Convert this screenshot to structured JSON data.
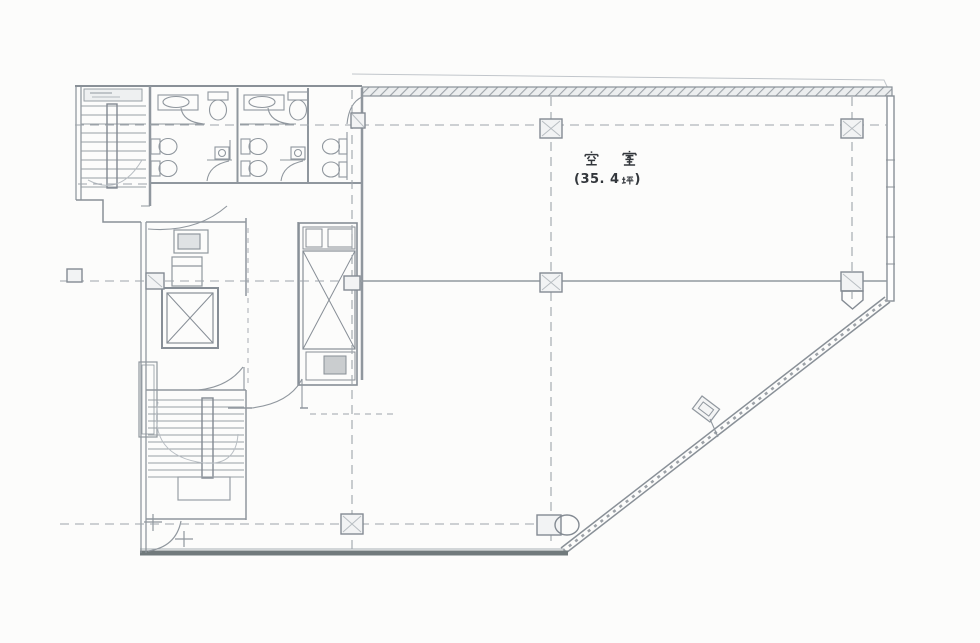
{
  "floor_plan": {
    "room_label": "空室",
    "area_label": "(35. 4坪)",
    "area_prefix": "(35. 4",
    "area_unit": "坪",
    "area_suffix": ")",
    "area_tsubo": 35.4
  },
  "colors": {
    "background": "#fcfcfb",
    "line": "#8d949c",
    "line_light": "#b6bcc2",
    "wall_dark": "#6d7678",
    "hatch": "#9aa1a7",
    "text": "#33373c"
  }
}
